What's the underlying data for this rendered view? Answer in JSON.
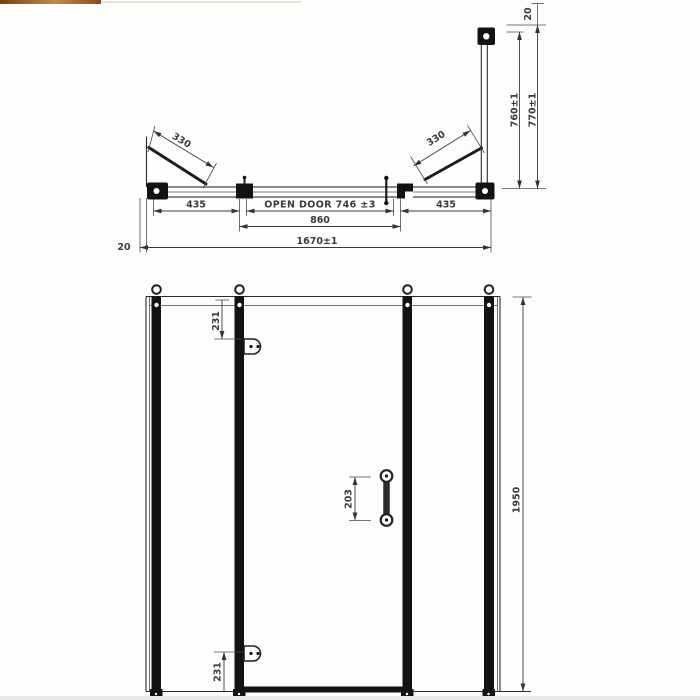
{
  "plan_view": {
    "swing_left": "330",
    "swing_right": "330",
    "panel_left": "435",
    "open_door": "OPEN DOOR 746 ±3",
    "panel_right": "435",
    "door_width": "860",
    "overall_width": "1670±1",
    "wall_adjust_left": "20",
    "depth_inner": "760±1",
    "depth_outer": "770±1",
    "wall_adjust_top": "20"
  },
  "front_view": {
    "hinge_top_offset": "231",
    "hinge_bottom_offset": "231",
    "handle_length": "203",
    "overall_height": "1950"
  }
}
